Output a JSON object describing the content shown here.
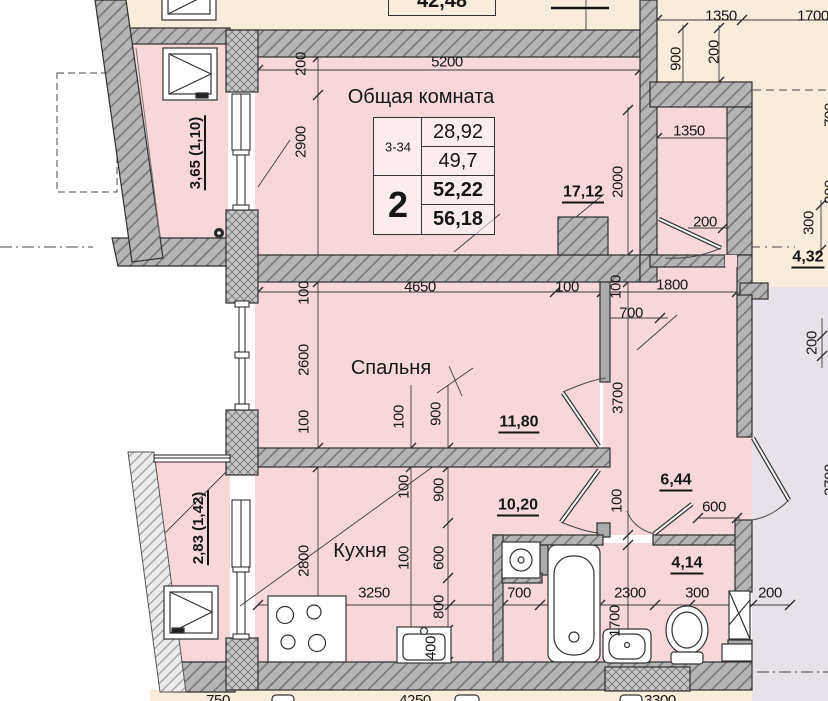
{
  "colors": {
    "room_fill": "#f7d7da",
    "neighbor_fill": "#f8ecdb",
    "corridor_fill": "#e7e2ea",
    "wall_fill": "#b5b5b5",
    "line": "#2f2f2f"
  },
  "unit_table": {
    "unit_code": "3-34",
    "room_count": "2",
    "area_1": "28,92",
    "area_2": "49,7",
    "area_3": "52,22",
    "area_total": "56,18",
    "neighbor_partial_area": "42,48"
  },
  "rooms": {
    "living": {
      "label": "Общая комната",
      "area": "17,12"
    },
    "bedroom": {
      "label": "Спальня",
      "area": "11,80"
    },
    "kitchen": {
      "label": "Кухня",
      "area": "10,20"
    },
    "hall": {
      "area": "6,44"
    },
    "bathroom": {
      "area": "4,14"
    },
    "corridor": {
      "area": "4,32"
    },
    "loggia_top": {
      "label": "3,65 (1,10)"
    },
    "loggia_bottom": {
      "label": "2,83 (1,42)"
    }
  },
  "dims": [
    "5200",
    "200",
    "2900",
    "100",
    "2600",
    "100",
    "2800",
    "4650",
    "100",
    "100",
    "700",
    "1800",
    "2000",
    "3700",
    "1350",
    "1700",
    "900",
    "200",
    "1350",
    "200",
    "300",
    "200",
    "100",
    "900",
    "100",
    "900",
    "100",
    "600",
    "800",
    "400",
    "3250",
    "100",
    "600",
    "700",
    "2300",
    "1700",
    "300",
    "200",
    "750",
    "4250",
    "3300",
    "700",
    "800",
    "3700"
  ]
}
